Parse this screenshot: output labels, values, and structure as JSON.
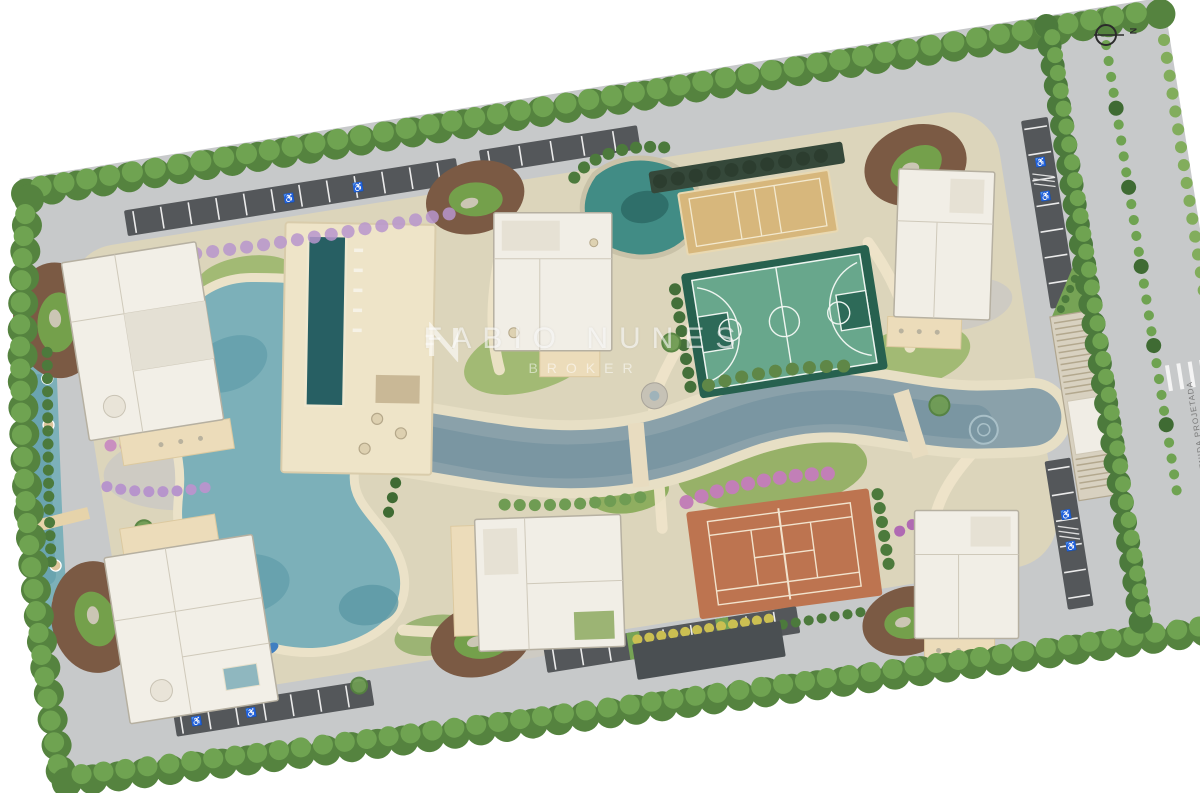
{
  "watermark": {
    "name": "FABIO NUNES",
    "role": "BROKER",
    "logo": "broker-monogram"
  },
  "compass": {
    "label": "N"
  },
  "street": {
    "name": "AVENIDA PROJETADA"
  },
  "parking": {
    "accessible_icon": "♿"
  },
  "features": [
    {
      "name": "lagoon-pool",
      "color": "#7cb0b9"
    },
    {
      "name": "lap-pool",
      "color": "#275f63"
    },
    {
      "name": "left-linear-pool",
      "color": "#7cb0b9"
    },
    {
      "name": "central-canal",
      "color": "#8aa1aa"
    },
    {
      "name": "natural-pond",
      "color": "#418c85"
    },
    {
      "name": "basketball-court",
      "color": "#68a78c"
    },
    {
      "name": "beach-volleyball-court",
      "color": "#d7b77c"
    },
    {
      "name": "clay-tennis-court",
      "color": "#bd7450"
    },
    {
      "name": "landscape-mound",
      "color": "#7b5a44"
    },
    {
      "name": "perimeter-trees",
      "color": "#55833f"
    },
    {
      "name": "parking-asphalt",
      "color": "#54575a"
    },
    {
      "name": "ring-road",
      "color": "#c7c9ca"
    },
    {
      "name": "building-roof",
      "color": "#f1eee6"
    },
    {
      "name": "gatehouse-pergola",
      "color": "#d8d1c0"
    }
  ]
}
